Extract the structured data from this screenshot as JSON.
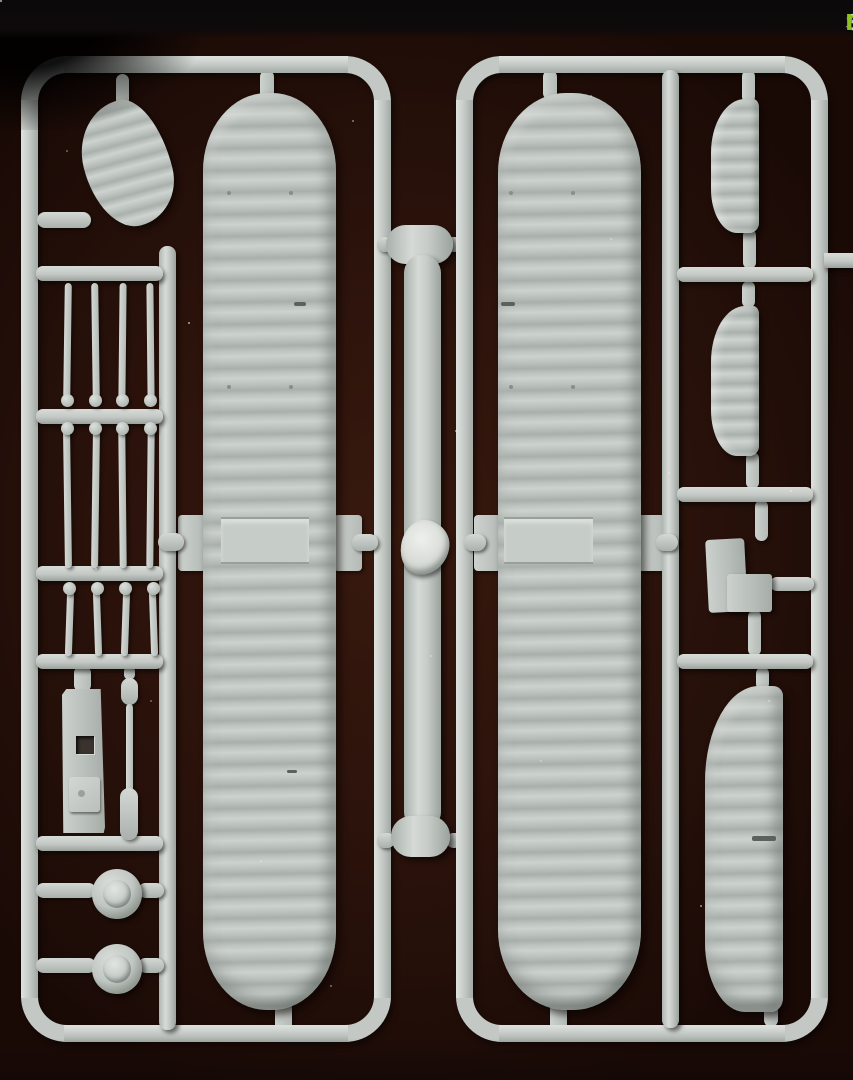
{
  "watermark": {
    "scale": "scale",
    "mates": "mates"
  },
  "colors": {
    "background": "#2a120b",
    "top_bar": "#0d0a0b",
    "plastic": "#c6ccc8",
    "plastic_highlight": "#dbdfdb",
    "plastic_shadow": "#9aa19d",
    "rib_highlight": "#ccd2ce",
    "rib_shadow": "#a9b0ac",
    "logo_scale": "#d3d3d3",
    "logo_mates": "#8dc222"
  },
  "scene": {
    "type": "scanned photograph of a light-grey injection-moulded model kit sprue",
    "backdrop": "dark maroon scanner background with black top edge",
    "frames": [
      "left runner frame",
      "right runner frame"
    ],
    "parts": [
      "wingtip fairing (top left)",
      "two long ribbed wing panels with centre-section tabs",
      "twelve thin struts in three ladder rows",
      "fuselage block with square opening and raised pad",
      "thin dumbbell rod",
      "two wheels with domed hubs",
      "central float rod with moulding flash blob",
      "two ribbed tailplane halves (right column)",
      "stepped fin part (right column)",
      "large ribbed stabiliser half (bottom right)",
      "runner crossbars, sprue gates and attachment pins"
    ]
  }
}
